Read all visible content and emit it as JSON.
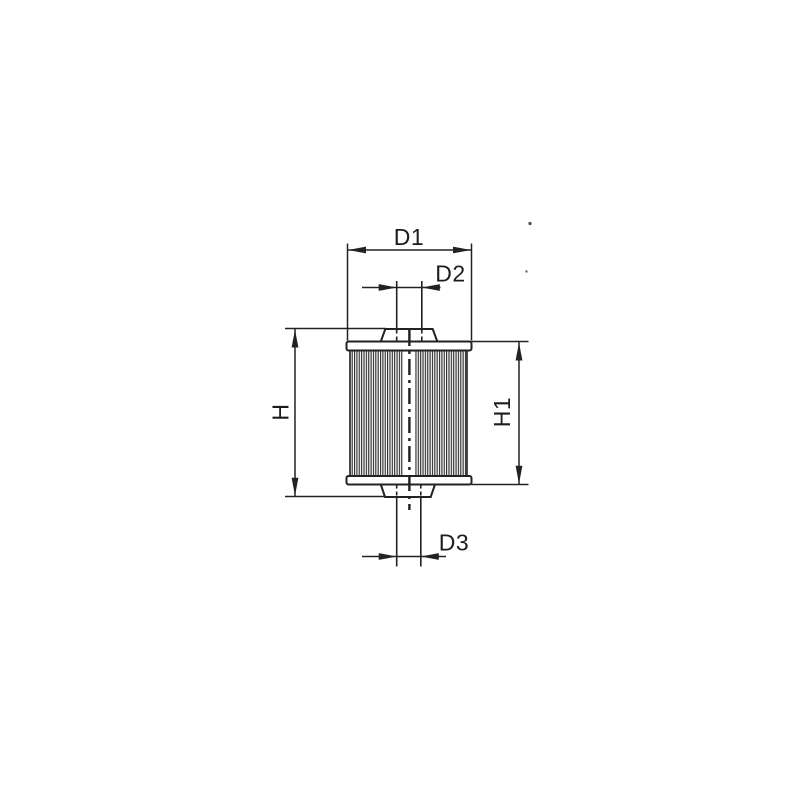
{
  "drawing": {
    "background_color": "#ffffff",
    "line_color": "#222222",
    "text_color": "#1c1c1c",
    "dimension_labels": {
      "d1": "D1",
      "d2": "D2",
      "d3": "D3",
      "h": "H",
      "h1": "H1"
    }
  }
}
